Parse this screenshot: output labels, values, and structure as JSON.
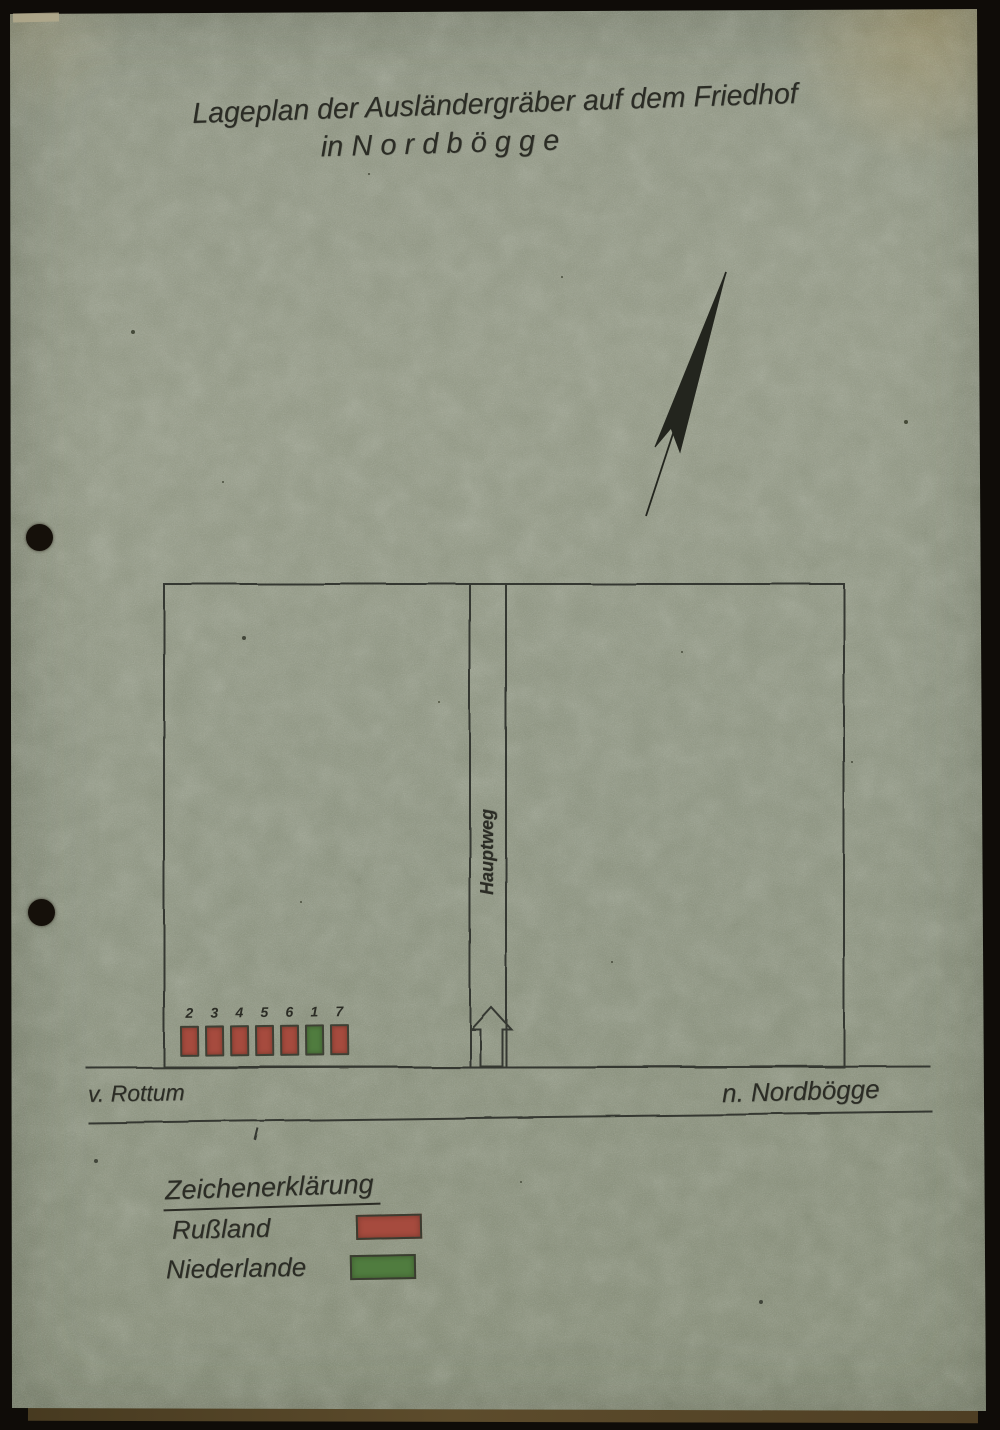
{
  "title": {
    "line1": "Lageplan der Ausländergräber auf dem Friedhof",
    "line2": "in N o r d b ö g g e"
  },
  "map": {
    "path_label": "Hauptweg",
    "road": {
      "left_label": "v. Rottum",
      "right_label": "n. Nordbögge"
    },
    "graves": [
      {
        "number": "2",
        "country": "Rußland",
        "color": "#a64b3e"
      },
      {
        "number": "3",
        "country": "Rußland",
        "color": "#a64b3e"
      },
      {
        "number": "4",
        "country": "Rußland",
        "color": "#a64b3e"
      },
      {
        "number": "5",
        "country": "Rußland",
        "color": "#a64b3e"
      },
      {
        "number": "6",
        "country": "Rußland",
        "color": "#a64b3e"
      },
      {
        "number": "1",
        "country": "Niederlande",
        "color": "#507c3f"
      },
      {
        "number": "7",
        "country": "Rußland",
        "color": "#a64b3e"
      }
    ]
  },
  "legend": {
    "title": "Zeichenerklärung",
    "entries": [
      {
        "label": "Rußland",
        "color": "#a64b3e"
      },
      {
        "label": "Niederlande",
        "color": "#507c3f"
      }
    ]
  },
  "icons": {
    "north_arrow": "north-arrow",
    "path_direction": "up-block-arrow"
  },
  "colors": {
    "paper": "#8c9181",
    "ink": "#2e2f28",
    "russia_red": "#a64b3e",
    "netherlands_green": "#507c3f"
  }
}
